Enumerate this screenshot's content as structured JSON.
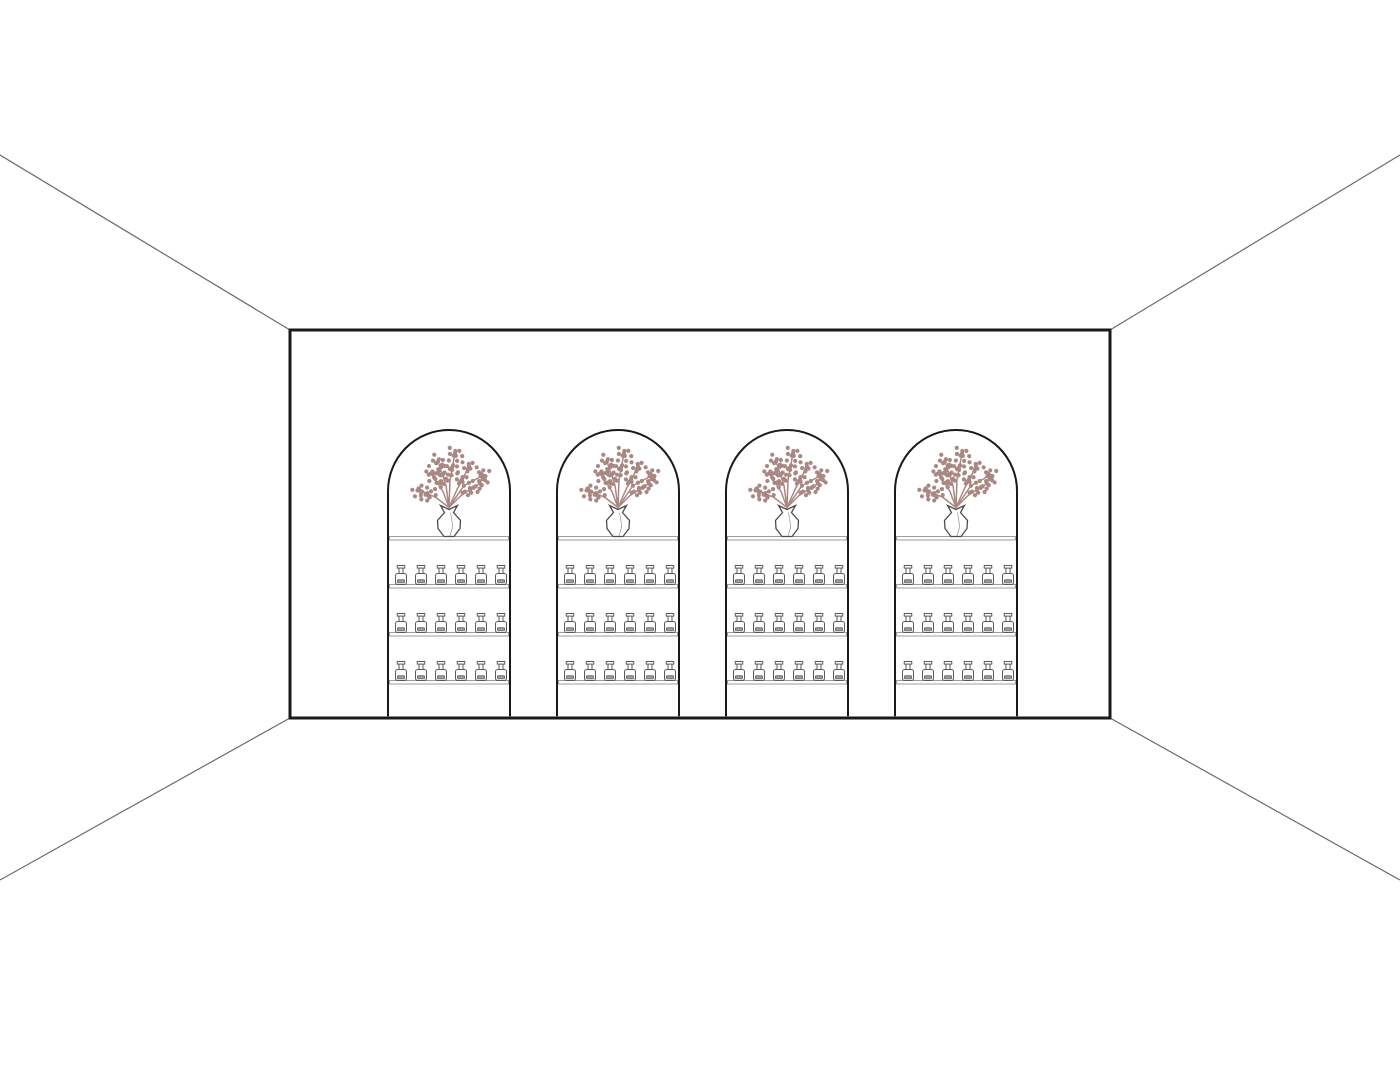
{
  "scene": {
    "description": "One-point perspective line drawing of a retail interior back wall with four arched display niches; each niche holds a vase of blossom branches on a top shelf and three lower shelves each lined with small bottles",
    "niche_count": 4,
    "shelves_per_niche": 3,
    "bottles_per_shelf": 6,
    "vases_per_niche": 1
  },
  "palette": {
    "background": "#ffffff",
    "wall_outline": "#1a1a1a",
    "niche_outline": "#1a1a1a",
    "perspective_line": "#6b6b6b",
    "shelf_line": "#9c9c9c",
    "bottle_outline": "#5a5a5a",
    "bottle_label_fill": "#9a9a9a",
    "bottle_label_outline": "#6b6b6b",
    "vase_outline": "#4d4d4d",
    "flower": "#a98783"
  }
}
